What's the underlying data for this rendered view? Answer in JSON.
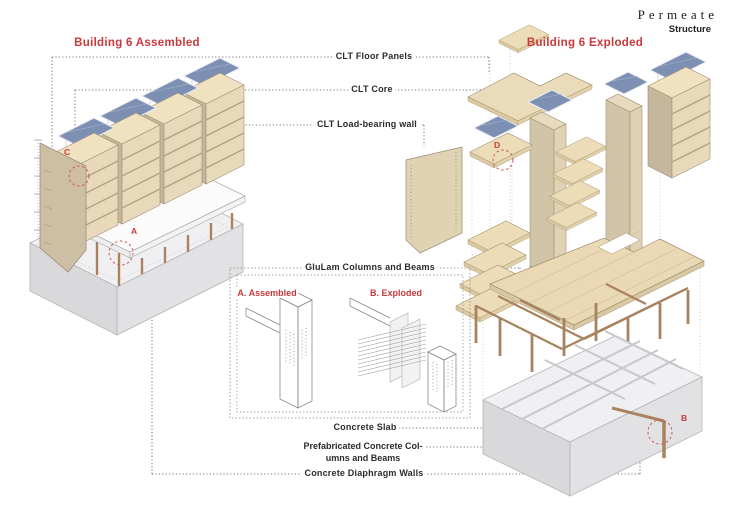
{
  "header": {
    "brand": "Permeate",
    "sheet_title": "Structure"
  },
  "views": {
    "assembled_title": "Building 6 Assembled",
    "exploded_title": "Building 6 Exploded"
  },
  "annotations": {
    "clt_floor_panels": "CLT Floor Panels",
    "clt_core": "CLT Core",
    "clt_load_bearing_wall": "CLT Load-bearing wall",
    "glulam_columns_beams": "GluLam Columns and Beams",
    "detail_assembled": "A. Assembled",
    "detail_exploded": "B. Exploded",
    "concrete_slab": "Concrete Slab",
    "precast_line1": "Prefabricated Concrete Col-",
    "precast_line2": "umns and Beams",
    "concrete_diaphragm_walls": "Concrete Diaphragm Walls"
  },
  "callouts": {
    "a": "A",
    "b": "B",
    "c": "C",
    "d": "D"
  },
  "colors": {
    "accent_red": "#c9393c",
    "wood_light": "#ecdcb8",
    "wood_face": "#e7d9ba",
    "wood_wall": "#c6b79c",
    "wood_edge": "#9d8f76",
    "solar_blue": "#7d90b3",
    "glulam_brown": "#a9825f",
    "concrete_top": "#f0f0f2",
    "concrete_side": "#d9d9dc",
    "leader_gray": "#4a4a4a"
  }
}
